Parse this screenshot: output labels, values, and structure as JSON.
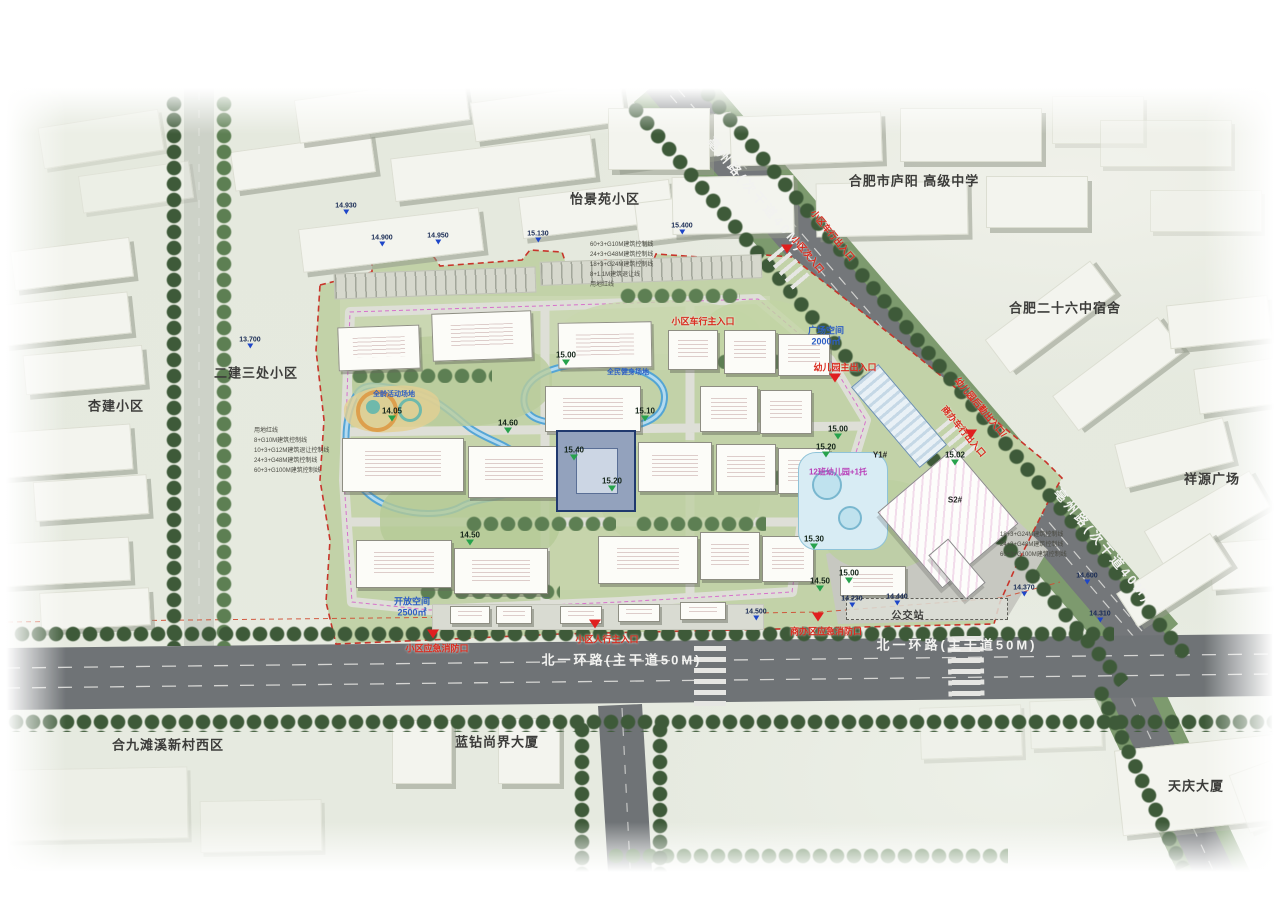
{
  "title": "住宅小区总平面规划图",
  "colors": {
    "site_green": "#c2d2a8",
    "asphalt": "#6f7376",
    "water_blue": "#4ea2d6",
    "boundary_red": "#c8352b",
    "entrance_red": "#d92b1e",
    "elev_green": "#27a24c",
    "marker_blue": "#1e46c8",
    "context_gray": "#f3f4ee"
  },
  "context_labels": [
    {
      "t": "怡景苑小区",
      "x": 605,
      "y": 198
    },
    {
      "t": "合肥市庐阳 高级中学",
      "x": 914,
      "y": 180
    },
    {
      "t": "合肥二十六中宿舍",
      "x": 1065,
      "y": 307
    },
    {
      "t": "祥源广场",
      "x": 1212,
      "y": 478
    },
    {
      "t": "二建三处小区",
      "x": 256,
      "y": 372
    },
    {
      "t": "杏建小区",
      "x": 116,
      "y": 405
    },
    {
      "t": "合九滩溪新村西区",
      "x": 168,
      "y": 744
    },
    {
      "t": "蓝钻尚界大厦",
      "x": 497,
      "y": 741
    },
    {
      "t": "天庆大厦",
      "x": 1196,
      "y": 785
    },
    {
      "t": "公交站",
      "x": 908,
      "y": 614,
      "s": 10
    }
  ],
  "road_labels": [
    {
      "t": "亳州路(次干道40M)",
      "x": 757,
      "y": 194,
      "r": 50
    },
    {
      "t": "亳州路(次干道40M)",
      "x": 1104,
      "y": 545,
      "r": 50
    },
    {
      "t": "北一环路(主干道50M)",
      "x": 622,
      "y": 659
    },
    {
      "t": "北一环路(主干道50M)",
      "x": 957,
      "y": 644
    }
  ],
  "entrance_labels": [
    {
      "t": "小区车行出入口",
      "x": 833,
      "y": 235,
      "r": 50
    },
    {
      "t": "小区次入口",
      "x": 808,
      "y": 254,
      "r": 50
    },
    {
      "t": "小区车行主入口",
      "x": 703,
      "y": 321
    },
    {
      "t": "幼儿园主出入口",
      "x": 845,
      "y": 367
    },
    {
      "t": "幼儿园后勤出入口/",
      "x": 981,
      "y": 407,
      "r": 50
    },
    {
      "t": "商办车行出入口",
      "x": 964,
      "y": 431,
      "r": 50
    },
    {
      "t": "小区应急消防口",
      "x": 437,
      "y": 648
    },
    {
      "t": "小区人行主入口",
      "x": 607,
      "y": 639
    },
    {
      "t": "商办区应急消防口",
      "x": 826,
      "y": 631
    }
  ],
  "entrance_markers": [
    {
      "x": 787,
      "y": 252
    },
    {
      "x": 835,
      "y": 381
    },
    {
      "x": 971,
      "y": 437
    },
    {
      "x": 595,
      "y": 627
    },
    {
      "x": 433,
      "y": 637
    },
    {
      "x": 818,
      "y": 620
    }
  ],
  "elevation_markers": [
    {
      "t": "15.00",
      "x": 566,
      "y": 360
    },
    {
      "t": "15.10",
      "x": 645,
      "y": 416
    },
    {
      "t": "15.40",
      "x": 574,
      "y": 455
    },
    {
      "t": "15.20",
      "x": 612,
      "y": 486
    },
    {
      "t": "14.05",
      "x": 392,
      "y": 416
    },
    {
      "t": "14.60",
      "x": 508,
      "y": 428
    },
    {
      "t": "14.50",
      "x": 470,
      "y": 540
    },
    {
      "t": "15.00",
      "x": 838,
      "y": 434
    },
    {
      "t": "15.02",
      "x": 955,
      "y": 460
    },
    {
      "t": "15.20",
      "x": 826,
      "y": 452
    },
    {
      "t": "15.30",
      "x": 814,
      "y": 544
    },
    {
      "t": "15.00",
      "x": 849,
      "y": 578
    },
    {
      "t": "14.50",
      "x": 820,
      "y": 586
    }
  ],
  "blue_markers": [
    {
      "t": "14.930",
      "x": 346,
      "y": 210
    },
    {
      "t": "14.900",
      "x": 382,
      "y": 242
    },
    {
      "t": "14.950",
      "x": 438,
      "y": 240
    },
    {
      "t": "15.130",
      "x": 538,
      "y": 238
    },
    {
      "t": "15.400",
      "x": 682,
      "y": 230
    },
    {
      "t": "13.700",
      "x": 250,
      "y": 344
    },
    {
      "t": "14.600",
      "x": 1087,
      "y": 580
    },
    {
      "t": "14.370",
      "x": 1024,
      "y": 592
    },
    {
      "t": "14.230",
      "x": 852,
      "y": 603
    },
    {
      "t": "14.440",
      "x": 897,
      "y": 601
    },
    {
      "t": "14.310",
      "x": 1100,
      "y": 618
    },
    {
      "t": "14.500",
      "x": 756,
      "y": 616
    }
  ],
  "area_labels": [
    {
      "t": "广场空间",
      "x": 826,
      "y": 330
    },
    {
      "t": "2000㎡",
      "x": 826,
      "y": 341
    },
    {
      "t": "开放空间",
      "x": 412,
      "y": 601
    },
    {
      "t": "2500㎡",
      "x": 412,
      "y": 612
    },
    {
      "t": "全民健身场地",
      "x": 628,
      "y": 372,
      "s": 7
    },
    {
      "t": "全龄活动场地",
      "x": 394,
      "y": 394,
      "s": 7
    }
  ],
  "site_labels": [
    {
      "t": "12班幼儿园+1托",
      "x": 838,
      "y": 472,
      "c": "#b83db8"
    },
    {
      "t": "Y1#",
      "x": 880,
      "y": 455,
      "c": "#222222"
    },
    {
      "t": "S2#",
      "x": 955,
      "y": 500,
      "c": "#222222"
    }
  ],
  "annotations": [
    {
      "x": 254,
      "y": 426,
      "lines": [
        "用地红线",
        "8+G10M建筑控制线",
        "10+3+G12M建筑退让控制线",
        "24+3+G48M建筑控制线",
        "60+3+G100M建筑控制线"
      ]
    },
    {
      "x": 590,
      "y": 240,
      "lines": [
        "60+3+G10M建筑控制线",
        "24+3+G48M建筑控制线",
        "18+3+G24M建筑控制线",
        "8+1.1M建筑退让线",
        "用地红线"
      ]
    },
    {
      "x": 1000,
      "y": 530,
      "lines": [
        "18+3+G24M建筑控制线",
        "24+3+G48M建筑控制线",
        "60+3+G100M建筑控制线"
      ]
    }
  ]
}
